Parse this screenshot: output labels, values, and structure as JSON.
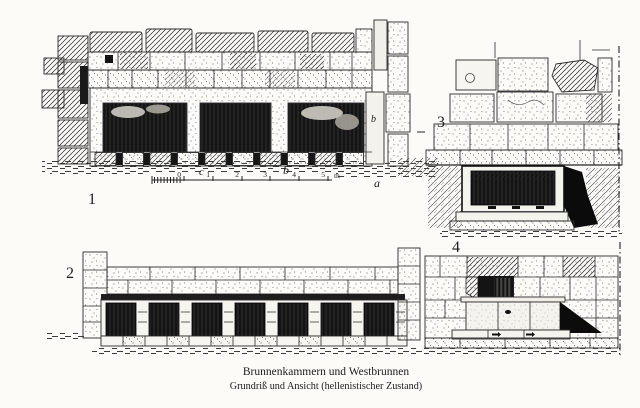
{
  "caption": {
    "line1": "Brunnenkammern und Westbrunnen",
    "line2": "Grundriß und Ansicht (hellenistischer Zustand)"
  },
  "figures": {
    "plan": {
      "number": "1",
      "pillar_letter": "b"
    },
    "elevation": {
      "number": "2"
    },
    "section": {
      "number": "3"
    },
    "fountain": {
      "number": "4"
    }
  },
  "scale_bar": {
    "ticks": [
      "0",
      "1",
      "2",
      "3",
      "4",
      "5"
    ],
    "unit": "m",
    "letter_c": "c",
    "letter_b": "b",
    "letter_a": "a"
  },
  "colors": {
    "ink": "#1c1c1c",
    "paper": "#fcfbf8"
  }
}
